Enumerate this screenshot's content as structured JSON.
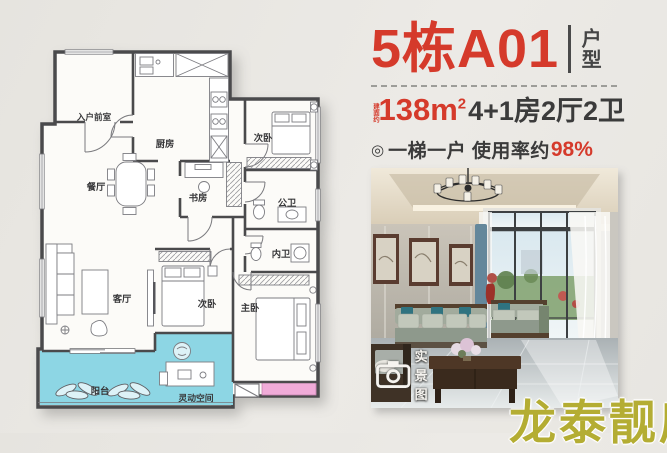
{
  "colors": {
    "accent_red": "#d53a2b",
    "ink": "#3b3b3b",
    "cyan": "#8dd6e4",
    "pink": "#f0abd8",
    "wall": "#4a4a4c",
    "watermark": "#b4ad33"
  },
  "header": {
    "title": "5栋A01",
    "tag": "户型"
  },
  "specs": {
    "area_prefix": "建面约",
    "area_value": "138m",
    "area_sup": "2",
    "layout": "4+1房2厅2卫"
  },
  "feature": {
    "icon": "◎",
    "text": "一梯一户 使用率约",
    "highlight": "98%"
  },
  "floorplan": {
    "rooms": [
      {
        "id": "entry",
        "label": "入户前室"
      },
      {
        "id": "kitchen",
        "label": "厨房"
      },
      {
        "id": "dining",
        "label": "餐厅"
      },
      {
        "id": "study",
        "label": "书房"
      },
      {
        "id": "bedroom2",
        "label": "次卧"
      },
      {
        "id": "public-bath",
        "label": "公卫"
      },
      {
        "id": "ensuite-bath",
        "label": "内卫"
      },
      {
        "id": "living",
        "label": "客厅"
      },
      {
        "id": "bedroom3",
        "label": "次卧"
      },
      {
        "id": "master",
        "label": "主卧"
      },
      {
        "id": "balcony",
        "label": "阳台"
      },
      {
        "id": "flex-space",
        "label": "灵动空间"
      }
    ]
  },
  "photo": {
    "badge_label": "实景图"
  },
  "watermark": {
    "text": "龙泰靓房"
  }
}
